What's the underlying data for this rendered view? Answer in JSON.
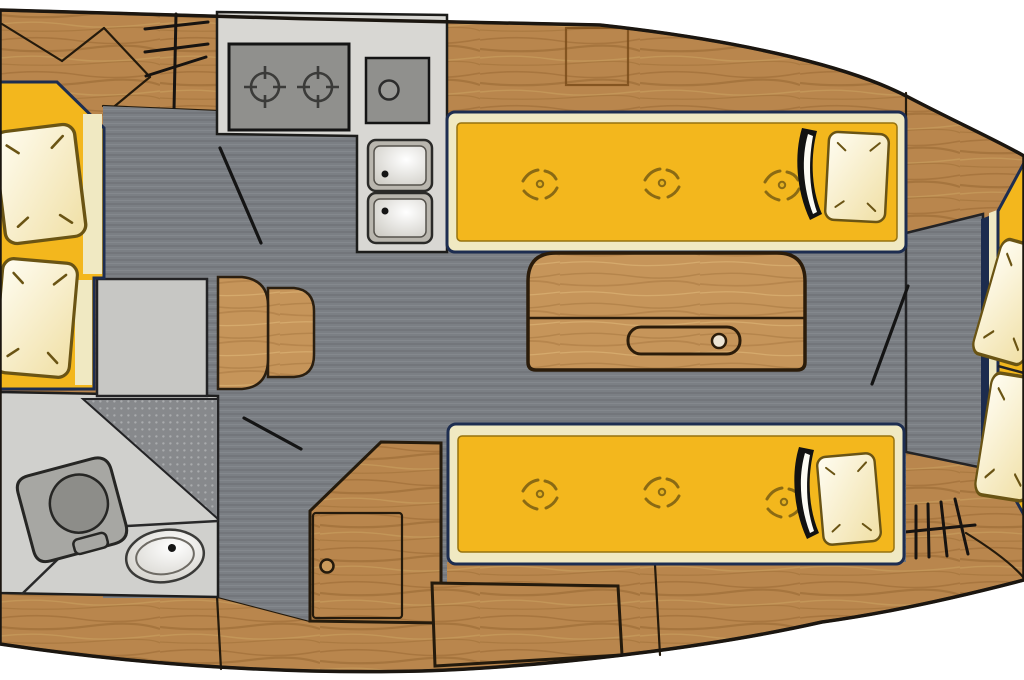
{
  "diagram": {
    "kind": "sailboat-interior-floor-plan",
    "view": "top-down"
  },
  "colors": {
    "background": "#ffffff",
    "hull_outline": "#1b1610",
    "wood": "#b9864d",
    "wood_line": "#241a0c",
    "wood_light": "#c6955a",
    "floor": "#7b7f84",
    "alcove": "#c7c7c4",
    "head_floor": "#d0d0cd",
    "shower_base": "#87898c",
    "counter": "#d8d7d3",
    "appliance": "#90908d",
    "appliance_line": "#3b3b39",
    "sink_rim": "#b9b6ae",
    "cushion": "#f3b71d",
    "cushion_border": "#f0e9c2",
    "cushion_edge": "#1d2d50",
    "tuft": "#8a6a14",
    "pillow_light": "#fffdf2",
    "pillow_shade": "#f0dfa4",
    "blanket_dark": "#121212",
    "blanket_light": "#fcfbf4",
    "fixture_gray": "#a7a7a3",
    "fixture_line": "#2a2a28",
    "door_line": "#141414",
    "bulkhead_navy": "#1c2c4e"
  },
  "inventory": {
    "berth_left": {
      "pillows": 2
    },
    "head_compartment": {
      "fixtures": [
        "toilet",
        "washbasin",
        "shower-floor"
      ]
    },
    "galley": {
      "stove_burners": 2,
      "round_basin": 1,
      "sink_bowls": 2
    },
    "salon": {
      "settees": 2,
      "button_tufts_per_settee": 3,
      "pillows": 2,
      "folded_blankets": 2,
      "table_leaf_slots": 1,
      "wood_steps": 2,
      "locker_doors": 1
    },
    "fore_berth": {
      "pillows": 2,
      "cushion_sections": 2
    },
    "step_ladders": 2,
    "door_swing_lines": 3
  }
}
